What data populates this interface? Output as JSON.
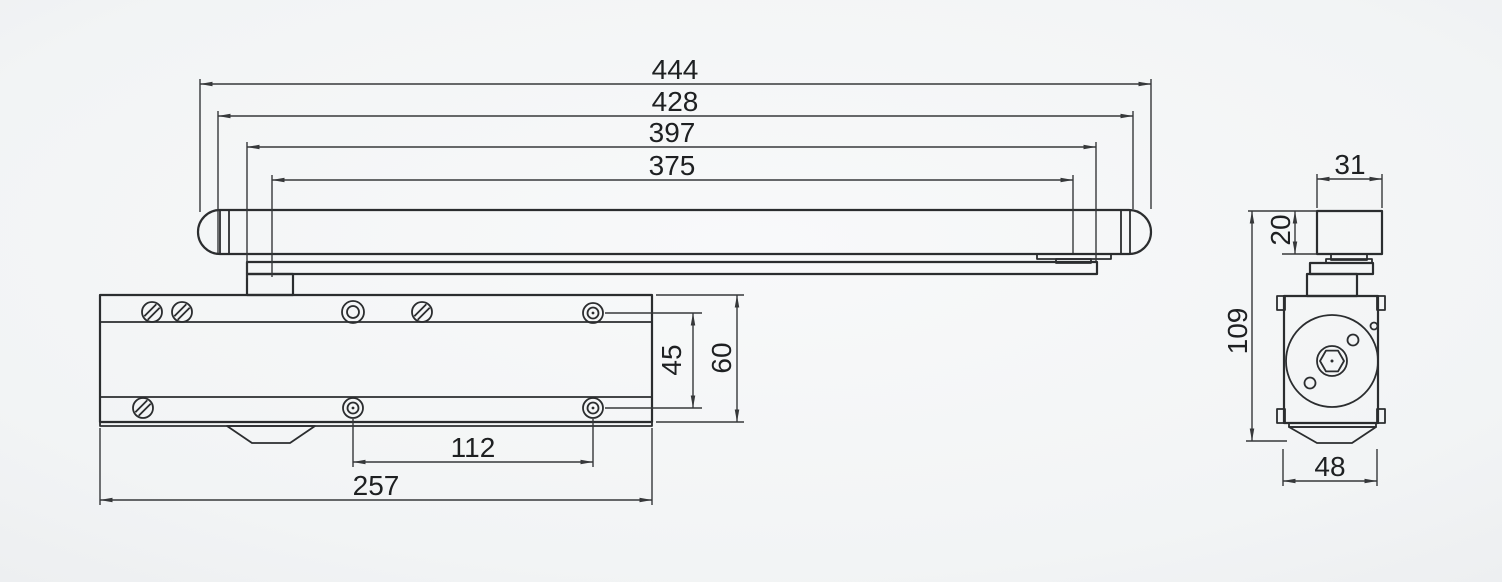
{
  "title": "Door closer with slide rail - dimensional drawing",
  "colors": {
    "background": "#f3f5f6",
    "outline": "#2b2d2f",
    "dimension_line": "#36383a",
    "text": "#1e2022"
  },
  "front_view": {
    "name": "front view (rail, arm and closer body)",
    "dimensions": {
      "overall_length": "444",
      "rail_length": "428",
      "arm_length": "397",
      "slide_travel": "375",
      "hole_pitch": "112",
      "body_length": "257",
      "hole_rise": "45",
      "body_height": "60"
    }
  },
  "side_view": {
    "name": "side view (cross-section)",
    "dimensions": {
      "rail_width": "31",
      "rail_height": "20",
      "overall_height": "109",
      "body_depth": "48"
    }
  }
}
